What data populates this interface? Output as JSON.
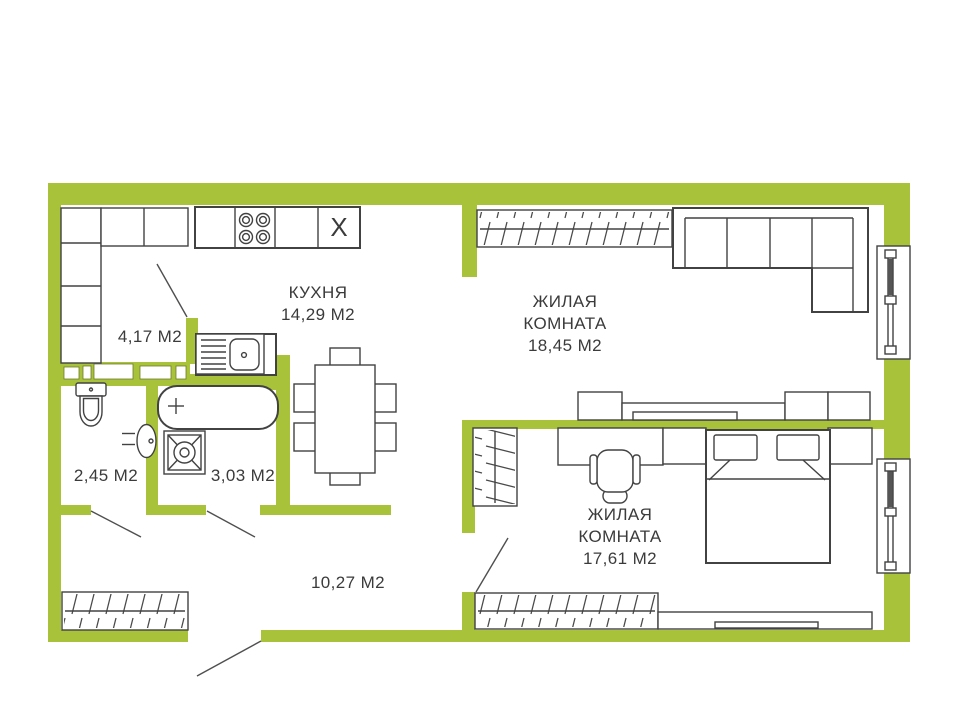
{
  "colors": {
    "wall": "#a8c23a",
    "line": "#424242",
    "line_thin": "#4f4f4f",
    "text": "#3b3b3b",
    "background": "#ffffff"
  },
  "rooms": [
    {
      "id": "kitchen",
      "name": "КУХНЯ",
      "area": "14,29 М2"
    },
    {
      "id": "living-room-1",
      "name_lines": [
        "ЖИЛАЯ",
        "КОМНАТА"
      ],
      "area": "18,45 М2"
    },
    {
      "id": "living-room-2",
      "name_lines": [
        "ЖИЛАЯ",
        "КОМНАТА"
      ],
      "area": "17,61 М2"
    },
    {
      "id": "dressing-room",
      "area": "4,17 М2"
    },
    {
      "id": "wc",
      "area": "2,45 М2"
    },
    {
      "id": "bathroom",
      "area": "3,03 М2"
    },
    {
      "id": "hallway",
      "area": "10,27 М2"
    }
  ],
  "fixtures": {
    "kitchen_cabinet_mark": "X"
  }
}
